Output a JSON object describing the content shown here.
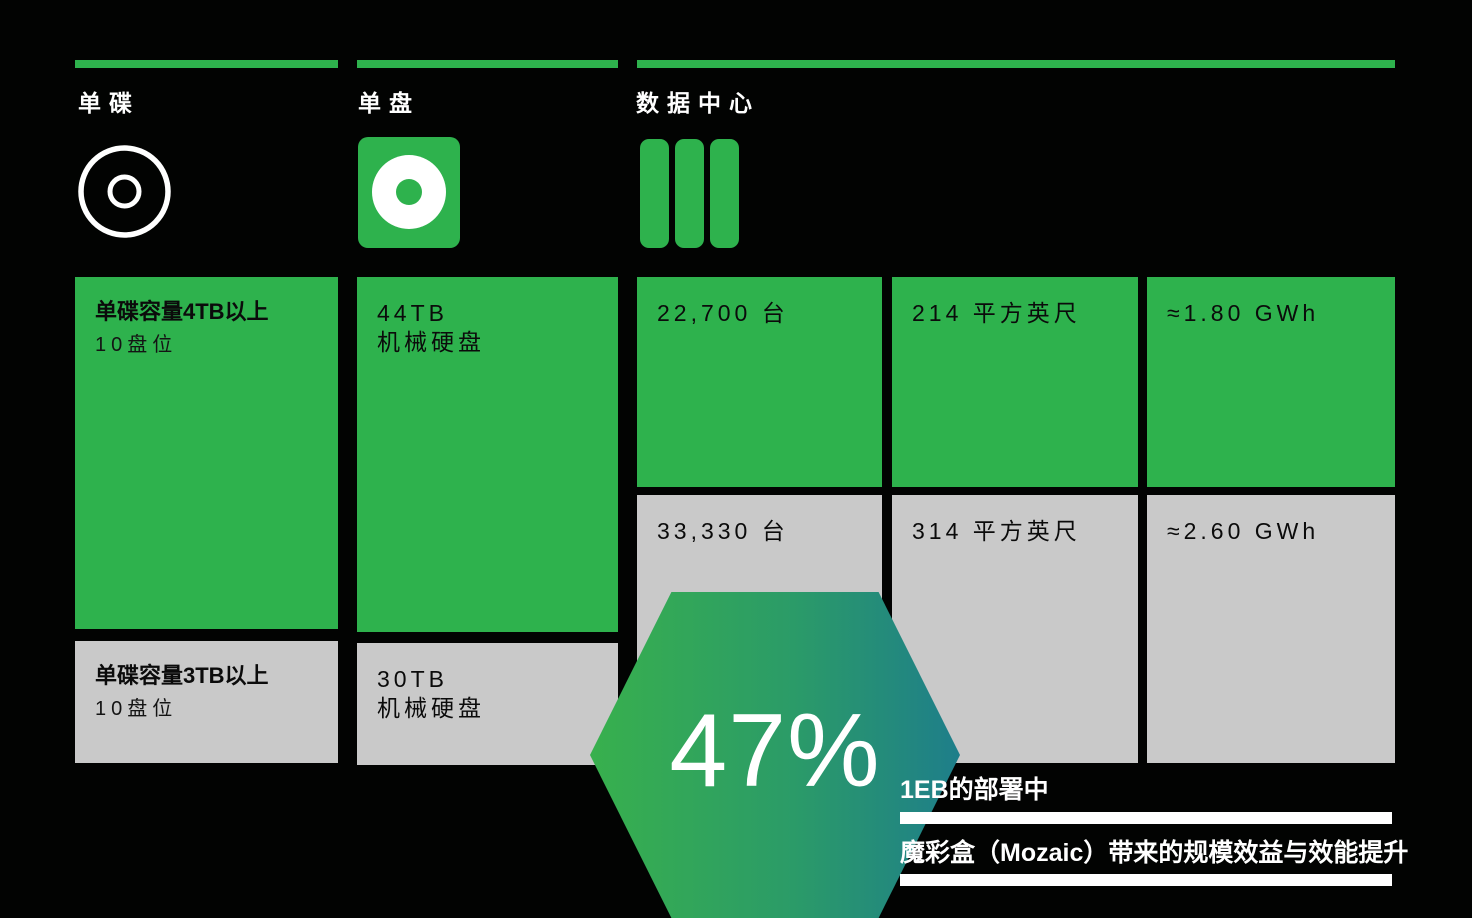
{
  "colors": {
    "background": "#020302",
    "accent_green": "#2EB24D",
    "neutral_gray": "#C9C9C9",
    "hex_gradient_start": "#38B04D",
    "hex_gradient_end": "#1E7E8A",
    "text_on_box": "#0B0B0B",
    "text_white": "#FFFFFF"
  },
  "columns": [
    {
      "label": "单碟",
      "icon": "disc-platter-icon"
    },
    {
      "label": "单盘",
      "icon": "hard-drive-icon"
    },
    {
      "label": "数据中心",
      "icon": "server-racks-icon"
    }
  ],
  "cards": {
    "platter_new": {
      "title": "单碟容量4TB以上",
      "subtitle": "10盘位"
    },
    "platter_old": {
      "title": "单碟容量3TB以上",
      "subtitle": "10盘位"
    },
    "drive_new": {
      "line1": "44TB",
      "line2": "机械硬盘"
    },
    "drive_old": {
      "line1": "30TB",
      "line2": "机械硬盘"
    },
    "dc_new": [
      "22,700 台",
      "214 平方英尺",
      "≈1.80 GWh"
    ],
    "dc_old": [
      "33,330 台",
      "314 平方英尺",
      "≈2.60 GWh"
    ]
  },
  "highlight": {
    "value": "47%",
    "line1": "1EB的部署中",
    "line2": "魔彩盒（Mozaic）带来的规模效益与效能提升"
  }
}
